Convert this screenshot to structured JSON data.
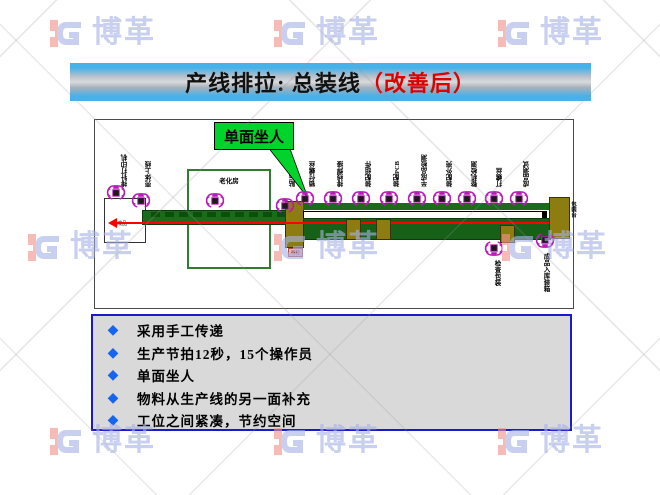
{
  "watermark": {
    "brand": "博革"
  },
  "title": {
    "main": "产线排拉: 总装线",
    "suffix": "（改善后）"
  },
  "diagram": {
    "callout_label": "单面坐人",
    "aging_room_label": "老化房",
    "finish_label": "成品",
    "chip_label": "待检",
    "pack_side_label": "包装台",
    "stations": [
      "排针打印机",
      "壳体上线",
      "贴标上料",
      "锁付螺丝",
      "排线焊接",
      "装配组件",
      "装配PCB",
      "半成品检测",
      "装配外壳",
      "整机检测",
      "打螺丝",
      "成品测试"
    ],
    "bottom_stations": [
      "检查包装",
      "成品入库装箱"
    ]
  },
  "bullets": {
    "items": [
      "采用手工传递",
      "生产节拍12秒，15个操作员",
      "单面坐人",
      "物料从生产线的另一面补充",
      "工位之间紧凑，节约空间"
    ]
  },
  "colors": {
    "callout_green": "#00d42a",
    "belt_green": "#1b6b1b",
    "olive": "#8d7d10",
    "flow_red": "#ff0000",
    "operator_magenta": "#b81cb8",
    "bullet_blue": "#1565f0",
    "panel_border_blue": "#1a1acc",
    "panel_gray": "#d9d9d9",
    "title_red": "#dd0000"
  }
}
